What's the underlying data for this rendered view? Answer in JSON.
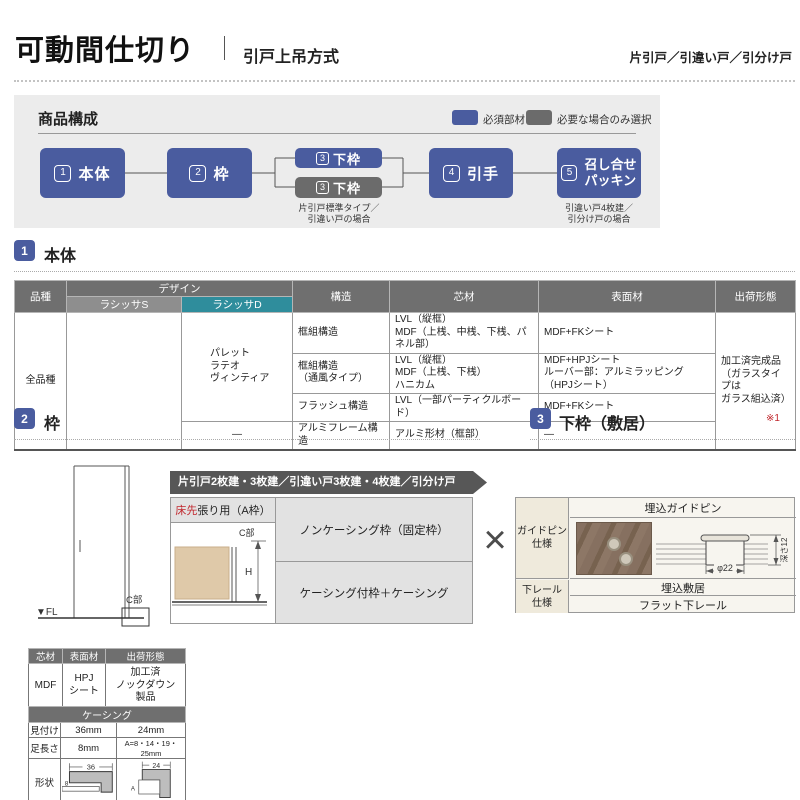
{
  "header": {
    "title": "可動間仕切り",
    "subtitle": "引戸上吊方式",
    "door_types": "片引戸／引違い戸／引分け戸"
  },
  "composition": {
    "title": "商品構成",
    "legend": [
      {
        "label": "必須部材"
      },
      {
        "label": "必要な場合のみ選択"
      }
    ],
    "nodes": [
      {
        "num": "1",
        "label": "本体"
      },
      {
        "num": "2",
        "label": "枠"
      },
      {
        "num": "3",
        "label": "下枠"
      },
      {
        "num": "3",
        "label": "下枠",
        "note": "片引戸標準タイプ／\n引違い戸の場合"
      },
      {
        "num": "4",
        "label": "引手"
      },
      {
        "num": "5",
        "label": "召し合せ\nパッキン",
        "note": "引違い戸4枚建／\n引分け戸の場合"
      }
    ]
  },
  "section1": {
    "num": "1",
    "title": "本体",
    "table": {
      "headers": {
        "hinshu": "品種",
        "design": "デザイン",
        "lasissa_s": "ラシッサS",
        "lasissa_d": "ラシッサD",
        "kozo": "構造",
        "shinzai": "芯材",
        "hyomen": "表面材",
        "shukka": "出荷形態"
      },
      "hinshu": "全品種",
      "lasissa_s": "",
      "lasissa_d": "パレット\nラテオ\nヴィンティア",
      "lasissa_d_alumi": "—",
      "rows": [
        {
          "kozo": "框組構造",
          "shinzai": "LVL（縦框）\nMDF（上桟、中桟、下桟、パネル部）",
          "hyomen": "MDF+FKシート"
        },
        {
          "kozo": "框組構造\n（通風タイプ）",
          "shinzai": "LVL（縦框）\nMDF（上桟、下桟）\nハニカム",
          "hyomen": "MDF+HPJシート\nルーバー部：アルミラッピング（HPJシート）"
        },
        {
          "kozo": "フラッシュ構造",
          "shinzai": "LVL（一部パーティクルボード）",
          "hyomen": "MDF+FKシート"
        },
        {
          "kozo": "アルミフレーム構造",
          "shinzai": "アルミ形材（框部）",
          "hyomen": "—"
        }
      ],
      "shukka": "加工済完成品\n（ガラスタイプは\nガラス組込済）"
    }
  },
  "section2": {
    "num": "2",
    "title": "枠",
    "banner": "片引戸2枚建・3枚建／引違い戸3枚建・4枚建／引分け戸",
    "frame_type": {
      "red": "床先",
      "rest": "張り用（A枠）"
    },
    "options": [
      "ノンケーシング枠（固定枠）",
      "ケーシング付枠＋ケーシング"
    ],
    "diagram": {
      "fl": "▼FL",
      "c_part": "C部",
      "c_part_detail": "C部",
      "h": "H"
    },
    "cross": "×"
  },
  "section3": {
    "num": "3",
    "title": "下枠（敷居）",
    "note": "※1",
    "guide_pin": {
      "label": "ガイドピン\n仕様",
      "header": "埋込ガイドピン",
      "dia": "φ22",
      "depth": "深さ12"
    },
    "lower_rail": {
      "label": "下レール\n仕様",
      "options": [
        "埋込敷居",
        "フラット下レール"
      ]
    }
  },
  "spec_table": {
    "headers": [
      "芯材",
      "表面材",
      "出荷形態"
    ],
    "cells": [
      "MDF",
      "HPJ\nシート",
      "加工済\nノックダウン\n製品"
    ]
  },
  "casing_table": {
    "title": "ケーシング",
    "row_mitsuke": {
      "label": "見付け",
      "v36": "36mm",
      "v24": "24mm"
    },
    "row_ashi": {
      "label": "足長さ",
      "v36": "8mm",
      "v24": "A=8・14・19・25mm"
    },
    "row_keijo": {
      "label": "形状"
    },
    "dims": {
      "d36": "36",
      "d8": "8",
      "d24": "24",
      "dA": "A"
    }
  },
  "colors": {
    "accent_blue": "#4a5c9f",
    "node_gray": "#6b6b6b",
    "table_header_gray": "#6f6f6f",
    "lasissa_d_teal": "#2f8d9c",
    "red": "#c1272d",
    "panel_bg": "#ececec"
  }
}
